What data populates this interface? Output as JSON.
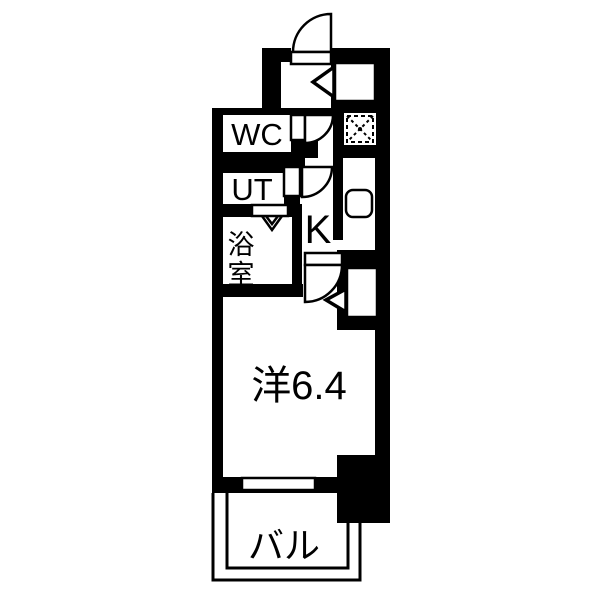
{
  "floorplan": {
    "rooms": {
      "wc": {
        "label": "WC"
      },
      "utility": {
        "label": "UT"
      },
      "bathroom": {
        "label": "浴室",
        "chars": [
          "浴",
          "室"
        ]
      },
      "kitchen": {
        "label": "K"
      },
      "western_room": {
        "label": "洋6.4"
      },
      "balcony": {
        "label": "バル"
      }
    },
    "fixtures": {
      "refrigerator_space_icon": "dashed-square-with-cross",
      "kitchen_sink_icon": "rounded-square",
      "entry_step_icon": "left-pointing-triangle",
      "room_step_icon": "left-pointing-triangle",
      "swing_door_icon": "quarter-circle-arc",
      "folding_door_icon": "double-chevron",
      "window_icon": "outlined-opening",
      "balcony_rail_icon": "double-line"
    },
    "colors": {
      "wall": "#000000",
      "floor": "#ffffff",
      "line": "#000000"
    }
  }
}
